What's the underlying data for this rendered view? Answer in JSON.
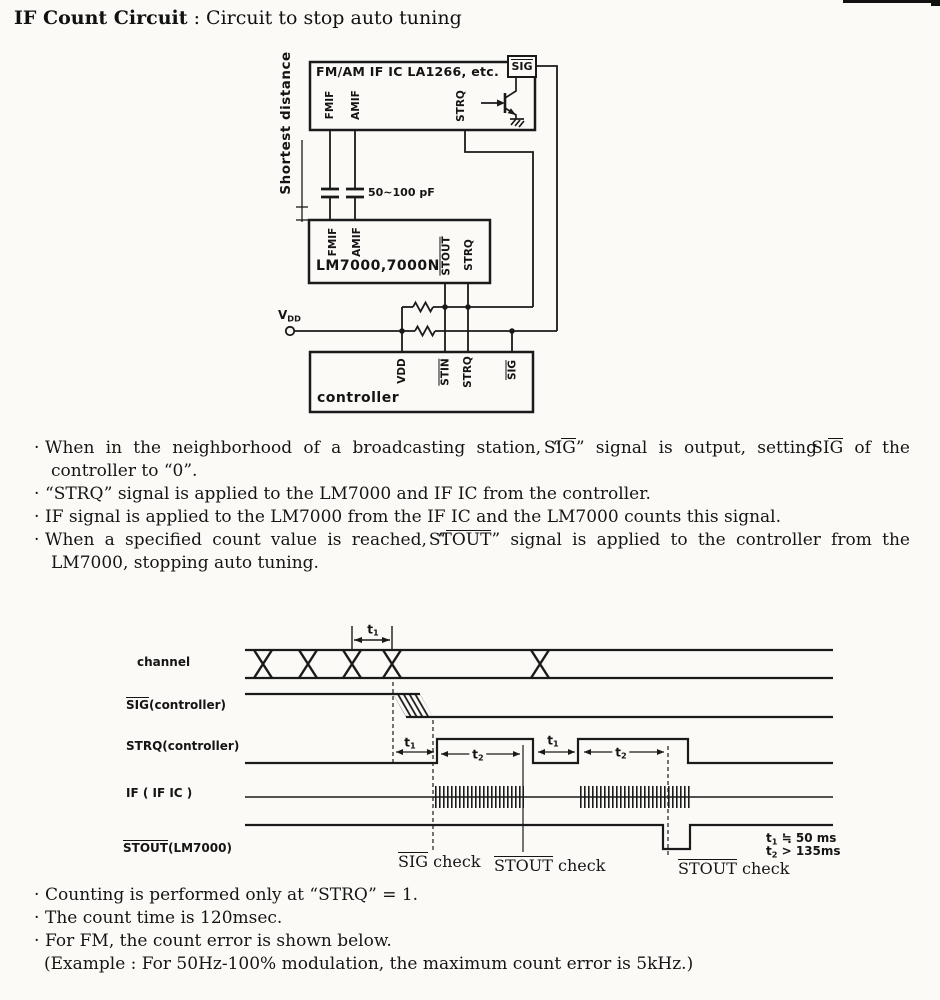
{
  "page": {
    "title_bold": "IF Count Circuit",
    "title_rest": " : Circuit to stop auto tuning",
    "bullet": "·"
  },
  "circuit": {
    "ic_label": "FM/AM IF IC  LA1266, etc.",
    "sig_pin": "SIG",
    "strq_pin": "STRQ",
    "fmif_pin": "FMIF",
    "amif_pin": "AMIF",
    "shortest_distance": "Shortest distance",
    "cap_value": "50~100 pF",
    "lm_label": "LM7000,7000N",
    "lm_fmif": "FMIF",
    "lm_amif": "AMIF",
    "lm_stout": "STOUT",
    "lm_strq": "STRQ",
    "vdd_base": "V",
    "vdd_sub": "DD",
    "ctrl_label": "controller",
    "ctrl_vdd": "VDD",
    "ctrl_stin": "STIN",
    "ctrl_strq": "STRQ",
    "ctrl_sig": "SIG"
  },
  "notes_top": [
    {
      "s0": "When in the neighborhood of a broadcasting station, “",
      "s1": "SIG",
      "s2": "” signal is output, setting ",
      "s3": "SIG",
      "s4": " of the controller to “0”."
    },
    {
      "s0": "“STRQ” signal is applied to the LM7000 and IF IC from the controller."
    },
    {
      "s0": "IF signal is applied to the LM7000 from the IF IC and the LM7000 counts this signal."
    },
    {
      "s0": "When a specified count value is reached, “",
      "s1": "STOUT",
      "s2": "” signal is applied to the controller from the LM7000, stopping auto tuning."
    }
  ],
  "timing": {
    "row_channel": "channel",
    "row_sig_name": "SIG",
    "row_sig_rest": "(controller)",
    "row_strq": "STRQ(controller)",
    "row_if": "IF ( IF IC )",
    "row_stout_name": "STOUT",
    "row_stout_rest": "(LM7000)",
    "t_base": "t",
    "t1_sub": "1",
    "t2_sub": "2",
    "check_sig_name": "SIG",
    "check_sig_rest": " check",
    "check_stout_name": "STOUT",
    "check_stout_rest": " check",
    "note_t1_rest": " ≒ 50 ms",
    "note_t2_rest": " > 135ms"
  },
  "notes_bottom": [
    {
      "s0": "Counting is performed only at “STRQ” = 1."
    },
    {
      "s0": "The count time is 120msec."
    },
    {
      "s0": "For FM, the count error is shown below."
    },
    {
      "s0": "(Example : For 50Hz-100% modulation, the maximum count error is 5kHz.)"
    }
  ]
}
